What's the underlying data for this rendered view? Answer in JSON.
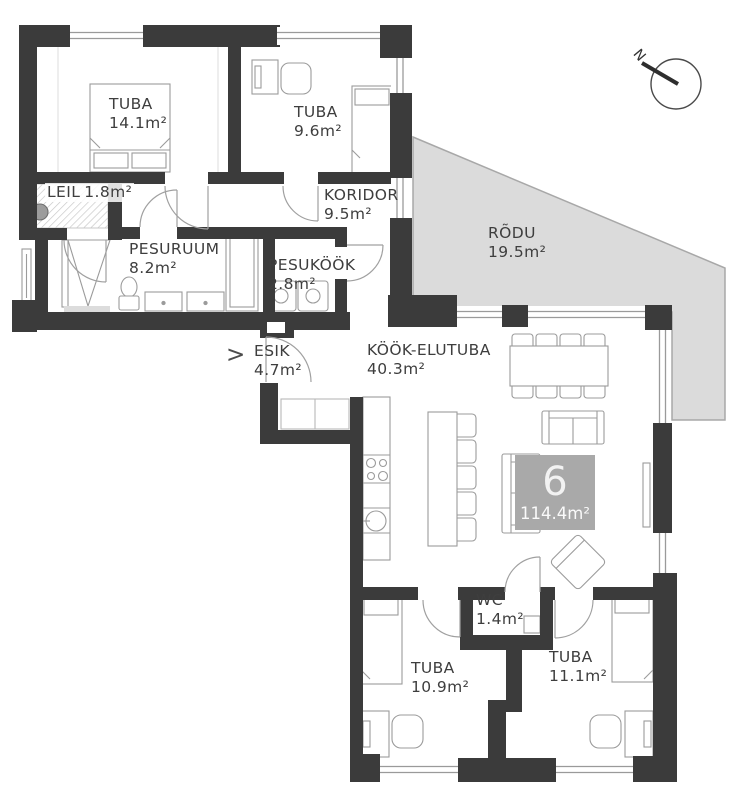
{
  "plan": {
    "unit_badge": {
      "number": "6",
      "area": "114.4m²"
    },
    "compass": {
      "label": "N"
    },
    "entry_marker": ">",
    "rooms": [
      {
        "id": "tuba-1",
        "name": "TUBA",
        "area": "14.1m²"
      },
      {
        "id": "tuba-2",
        "name": "TUBA",
        "area": "9.6m²"
      },
      {
        "id": "leil",
        "name": "LEIL",
        "area": "1.8m²"
      },
      {
        "id": "koridor",
        "name": "KORIDOR",
        "area": "9.5m²"
      },
      {
        "id": "pesuruum",
        "name": "PESURUUM",
        "area": "8.2m²"
      },
      {
        "id": "pesukook",
        "name": "PESUKÖÖK",
        "area": "2.8m²"
      },
      {
        "id": "rodu",
        "name": "RÕDU",
        "area": "19.5m²"
      },
      {
        "id": "esik",
        "name": "ESIK",
        "area": "4.7m²"
      },
      {
        "id": "kook-elutuba",
        "name": "KÖÖK-ELUTUBA",
        "area": "40.3m²"
      },
      {
        "id": "wc",
        "name": "WC",
        "area": "1.4m²"
      },
      {
        "id": "tuba-3",
        "name": "TUBA",
        "area": "10.9m²"
      },
      {
        "id": "tuba-4",
        "name": "TUBA",
        "area": "11.1m²"
      }
    ],
    "colors": {
      "wall": "#3b3b3b",
      "balcony": "#dbdbdb",
      "badge": "#a9a9a9",
      "furniture": "#9b9b9b"
    }
  }
}
